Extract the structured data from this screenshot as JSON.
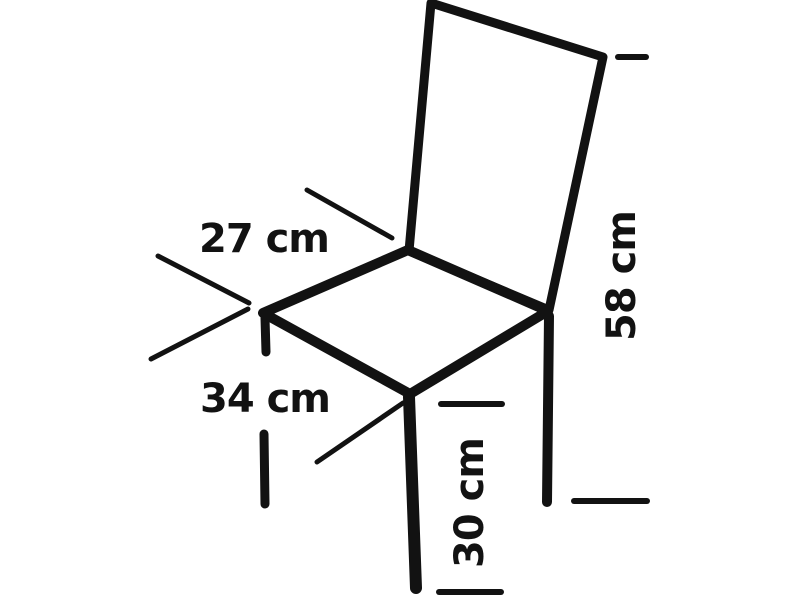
{
  "diagram": {
    "type": "chair-dimension-drawing",
    "background_color": "#ffffff",
    "line_color": "#121212",
    "unit": "cm",
    "dimensions": {
      "seat_edge_back_left": {
        "label": "27 cm",
        "value": 27
      },
      "seat_edge_front_left": {
        "label": "34 cm",
        "value": 34
      },
      "overall_back_height": {
        "label": "58 cm",
        "value": 58
      },
      "front_leg_height": {
        "label": "30 cm",
        "value": 30
      }
    }
  }
}
